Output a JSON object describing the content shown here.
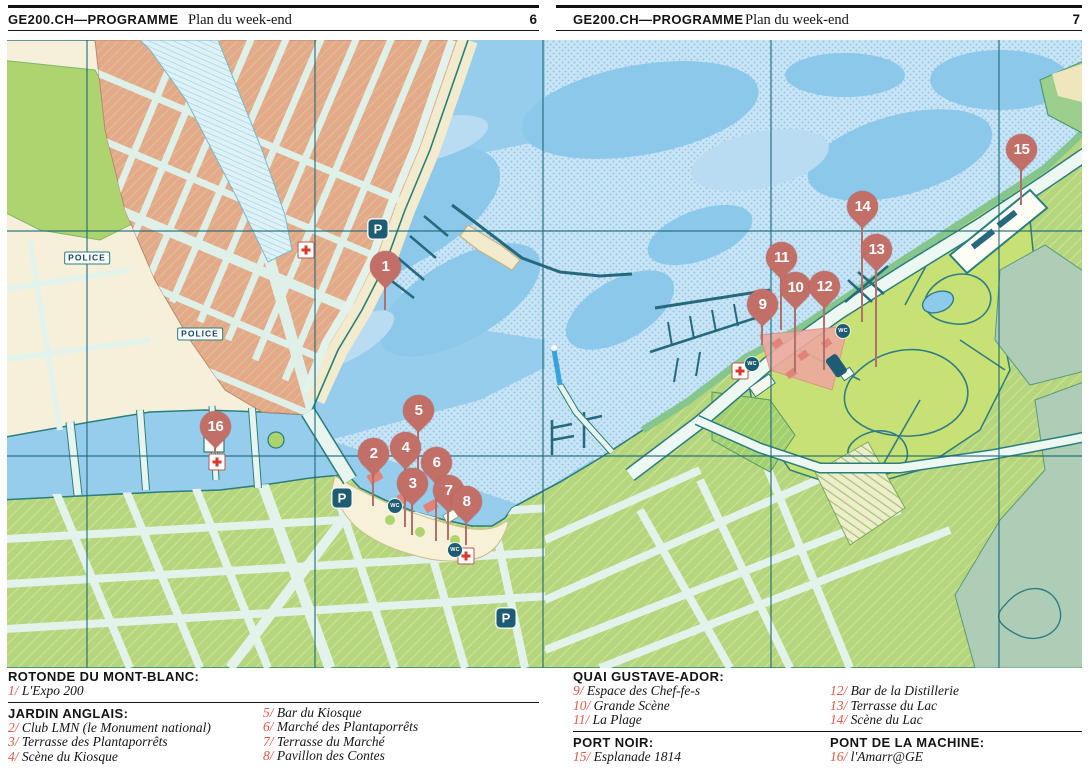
{
  "pages": [
    {
      "brand": "GE200.CH—PROGRAMME",
      "title": "Plan du week-end",
      "number": "6"
    },
    {
      "brand": "GE200.CH—PROGRAMME",
      "title": "Plan du week-end",
      "number": "7"
    }
  ],
  "map": {
    "colors": {
      "marker": "#c26f68",
      "water": "#97cdec",
      "graticule": "#1c6878",
      "legend_number": "#e25746"
    },
    "police_labels": [
      {
        "label": "POLICE",
        "x": 87,
        "y": 258
      },
      {
        "label": "POLICE",
        "x": 200,
        "y": 334
      }
    ],
    "markers": [
      {
        "n": "1",
        "x": 385,
        "y": 268,
        "tip": 310
      },
      {
        "n": "2",
        "x": 373,
        "y": 455,
        "tip": 506
      },
      {
        "n": "3",
        "x": 412,
        "y": 485,
        "tip": 535
      },
      {
        "n": "4",
        "x": 405,
        "y": 449,
        "tip": 527
      },
      {
        "n": "5",
        "x": 418,
        "y": 412,
        "tip": 487
      },
      {
        "n": "6",
        "x": 436,
        "y": 464,
        "tip": 541
      },
      {
        "n": "7",
        "x": 448,
        "y": 492,
        "tip": 540
      },
      {
        "n": "8",
        "x": 466,
        "y": 503,
        "tip": 545
      },
      {
        "n": "9",
        "x": 762,
        "y": 306,
        "tip": 345
      },
      {
        "n": "10",
        "x": 795,
        "y": 289,
        "tip": 372
      },
      {
        "n": "11",
        "x": 781,
        "y": 259,
        "tip": 330
      },
      {
        "n": "12",
        "x": 824,
        "y": 288,
        "tip": 370
      },
      {
        "n": "13",
        "x": 876,
        "y": 251,
        "tip": 367
      },
      {
        "n": "14",
        "x": 862,
        "y": 208,
        "tip": 322
      },
      {
        "n": "15",
        "x": 1021,
        "y": 151,
        "tip": 205
      },
      {
        "n": "16",
        "x": 215,
        "y": 428,
        "tip": 455
      }
    ],
    "amenities": [
      {
        "type": "parking",
        "label": "P",
        "x": 378,
        "y": 229
      },
      {
        "type": "parking",
        "label": "P",
        "x": 342,
        "y": 498
      },
      {
        "type": "parking",
        "label": "P",
        "x": 506,
        "y": 618
      },
      {
        "type": "firstaid",
        "label": "",
        "x": 306,
        "y": 250
      },
      {
        "type": "firstaid",
        "label": "",
        "x": 217,
        "y": 462
      },
      {
        "type": "firstaid",
        "label": "",
        "x": 466,
        "y": 556
      },
      {
        "type": "firstaid",
        "label": "",
        "x": 740,
        "y": 371
      },
      {
        "type": "wc",
        "label": "WC",
        "x": 395,
        "y": 506
      },
      {
        "type": "wc",
        "label": "WC",
        "x": 455,
        "y": 550
      },
      {
        "type": "wc",
        "label": "WC",
        "x": 752,
        "y": 364
      },
      {
        "type": "wc",
        "label": "WC",
        "x": 843,
        "y": 331
      }
    ]
  },
  "legend": {
    "left": {
      "blocks": [
        {
          "title": "ROTONDE DU MONT-BLANC:",
          "col1": [
            {
              "n": "1",
              "label": "L'Expo 200"
            }
          ],
          "col2": [],
          "col2_pad": false,
          "rule_after": true
        },
        {
          "title": "JARDIN ANGLAIS:",
          "col1": [
            {
              "n": "2",
              "label": "Club LMN (le Monument national)"
            },
            {
              "n": "3",
              "label": "Terrasse des Plantaporrêts"
            },
            {
              "n": "4",
              "label": "Scène du Kiosque"
            }
          ],
          "col2": [
            {
              "n": "5",
              "label": "Bar du Kiosque"
            },
            {
              "n": "6",
              "label": "Marché des Plantaporrêts"
            },
            {
              "n": "7",
              "label": "Terrasse du Marché"
            },
            {
              "n": "8",
              "label": "Pavillon des Contes"
            }
          ],
          "col2_pad": false,
          "rule_after": false
        }
      ]
    },
    "right": {
      "blocks": [
        {
          "title": "QUAI GUSTAVE-ADOR:",
          "col1": [
            {
              "n": "9",
              "label": "Espace des Chef-fe-s"
            },
            {
              "n": "10",
              "label": "Grande Scène"
            },
            {
              "n": "11",
              "label": "La Plage"
            }
          ],
          "col2": [
            {
              "n": "12",
              "label": "Bar de la Distillerie"
            },
            {
              "n": "13",
              "label": "Terrasse du Lac"
            },
            {
              "n": "14",
              "label": "Scène du Lac"
            }
          ],
          "col2_pad": true,
          "rule_after": true
        },
        {
          "twin": [
            {
              "title": "PORT NOIR:",
              "items": [
                {
                  "n": "15",
                  "label": "Esplanade 1814"
                }
              ]
            },
            {
              "title": "PONT DE LA MACHINE:",
              "items": [
                {
                  "n": "16",
                  "label": "l'Amarr@GE"
                }
              ]
            }
          ]
        }
      ]
    }
  }
}
